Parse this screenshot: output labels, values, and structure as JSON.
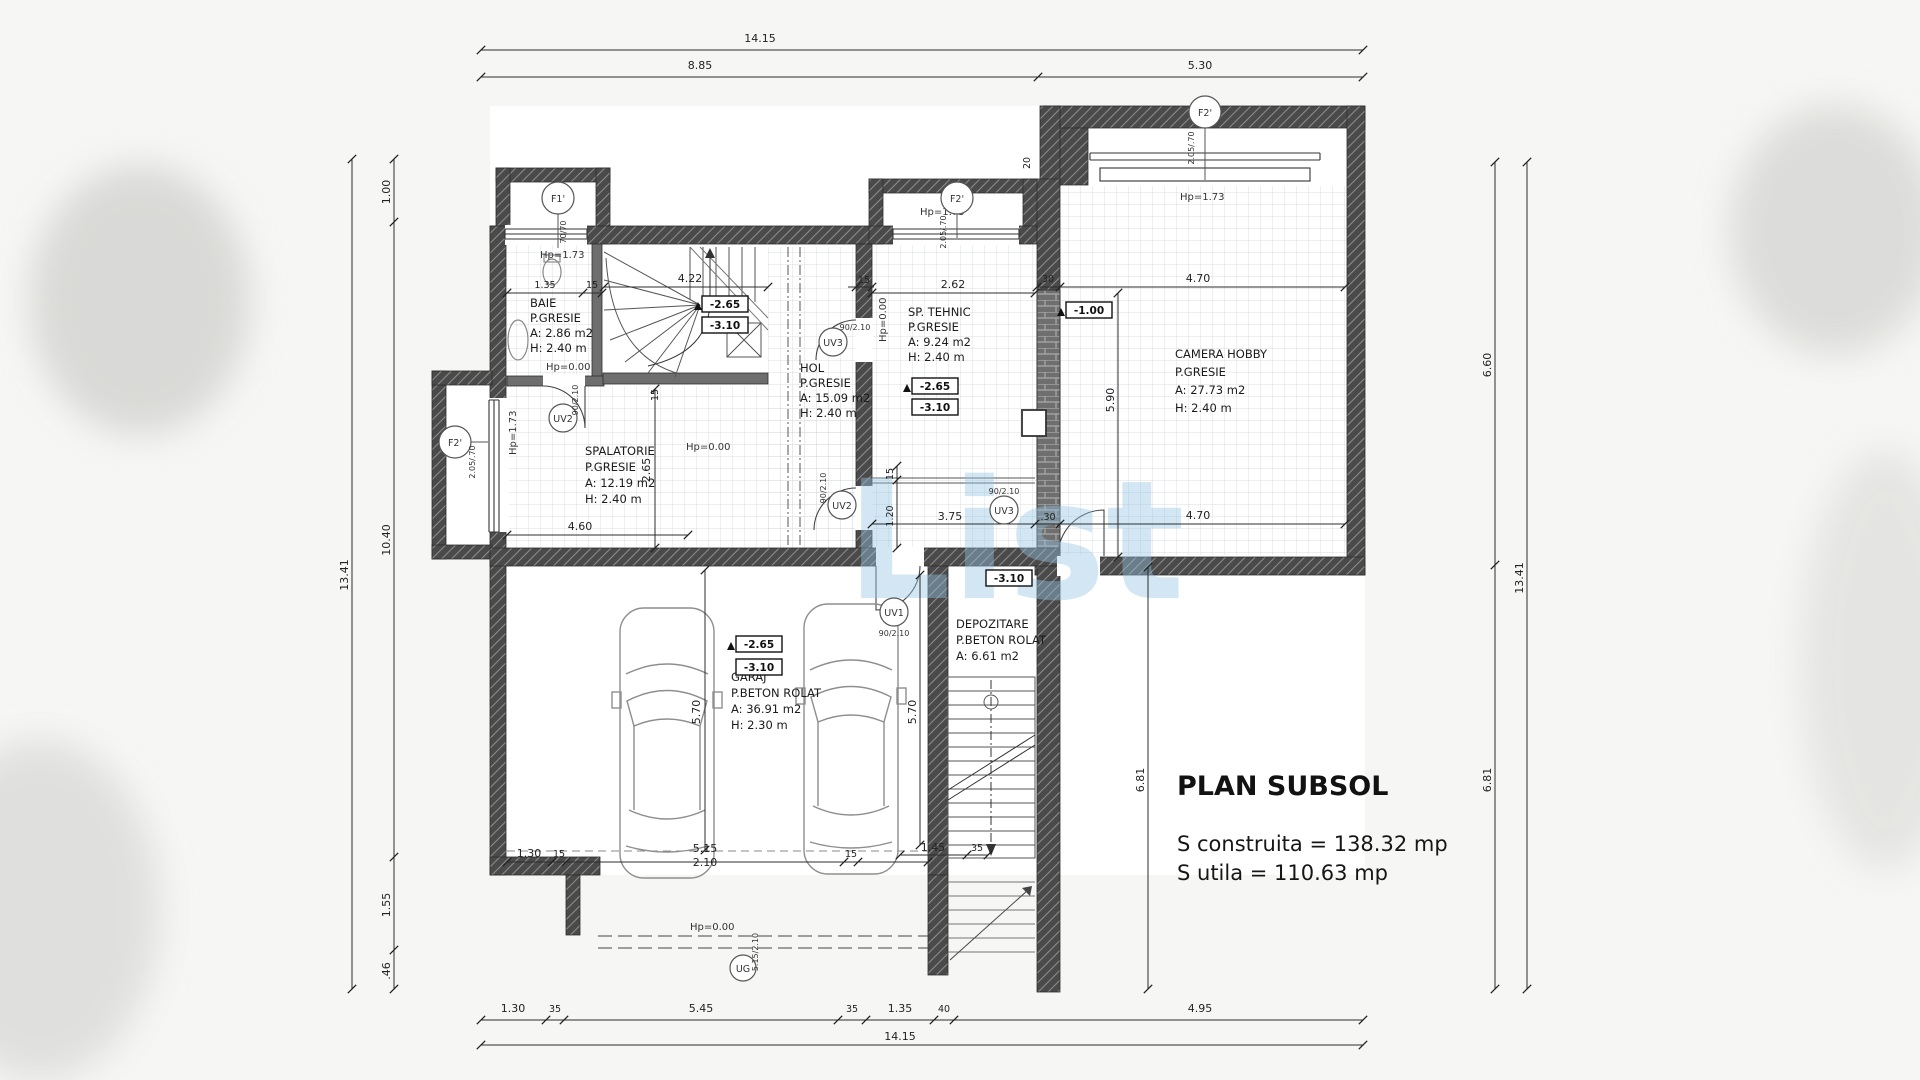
{
  "watermark": "List",
  "title_block": {
    "title": "PLAN SUBSOL",
    "area_built": "S construita = 138.32 mp",
    "area_usable": "S utila = 110.63 mp"
  },
  "rooms": [
    {
      "name": "BAIE",
      "finish": "P.GRESIE",
      "area": "A: 2.86 m2",
      "height": "H: 2.40 m"
    },
    {
      "name": "SPALATORIE",
      "finish": "P.GRESIE",
      "area": "A: 12.19 m2",
      "height": "H: 2.40 m"
    },
    {
      "name": "HOL",
      "finish": "P.GRESIE",
      "area": "A: 15.09 m2",
      "height": "H: 2.40 m"
    },
    {
      "name": "SP. TEHNIC",
      "finish": "P.GRESIE",
      "area": "A: 9.24 m2",
      "height": "H: 2.40 m"
    },
    {
      "name": "CAMERA HOBBY",
      "finish": "P.GRESIE",
      "area": "A: 27.73 m2",
      "height": "H: 2.40 m"
    },
    {
      "name": "GARAJ",
      "finish": "P.BETON ROLAT",
      "area": "A: 36.91 m2",
      "height": "H: 2.30 m"
    },
    {
      "name": "DEPOZITARE",
      "finish": "P.BETON ROLAT",
      "area": "A: 6.61 m2"
    }
  ],
  "levels": [
    "-2.65",
    "-3.10",
    "-2.65",
    "-3.10",
    "-1.00",
    "-2.65",
    "-3.10",
    "-3.10"
  ],
  "markers": [
    {
      "id": "F1'",
      "size": "70/70"
    },
    {
      "id": "F2'",
      "size": "2.05/.70"
    },
    {
      "id": "F2'",
      "size": "2.05/.70"
    },
    {
      "id": "F2'",
      "size": "2.05/.70"
    },
    {
      "id": "UV2",
      "size": "90/2.10"
    },
    {
      "id": "UV3",
      "size": "90/2.10"
    },
    {
      "id": "UV2",
      "size": "90/2.10"
    },
    {
      "id": "UV3",
      "size": "90/2.10"
    },
    {
      "id": "UV1",
      "size": "90/2.10"
    },
    {
      "id": "UG",
      "size": "5.15/2.10"
    }
  ],
  "hp_labels": [
    "Hp=1.73",
    "Hp=1.73",
    "Hp=1.73",
    "Hp=1.73",
    "Hp=0.00",
    "Hp=0.00",
    "Hp=0.00",
    "Hp=0.00"
  ],
  "dims": [
    "14.15",
    "8.85",
    "5.30",
    "14.15",
    "1.30",
    "35",
    "5.45",
    "35",
    "1.35",
    "40",
    "4.95",
    "13.41",
    "1.00",
    "10.40",
    "1.55",
    ".46",
    "13.41",
    "6.60",
    "6.81",
    "6.81",
    "5.90",
    "1.35",
    "15",
    "4.22",
    "15",
    "2.62",
    "4.70",
    "30",
    "4.60",
    "2.65",
    "3.75",
    "1.20",
    "15",
    ".30",
    "4.70",
    "5.15",
    "2.10",
    "1.30",
    "15",
    "15",
    "1.45",
    "35",
    "5.70",
    "5.70",
    "20",
    "15"
  ]
}
